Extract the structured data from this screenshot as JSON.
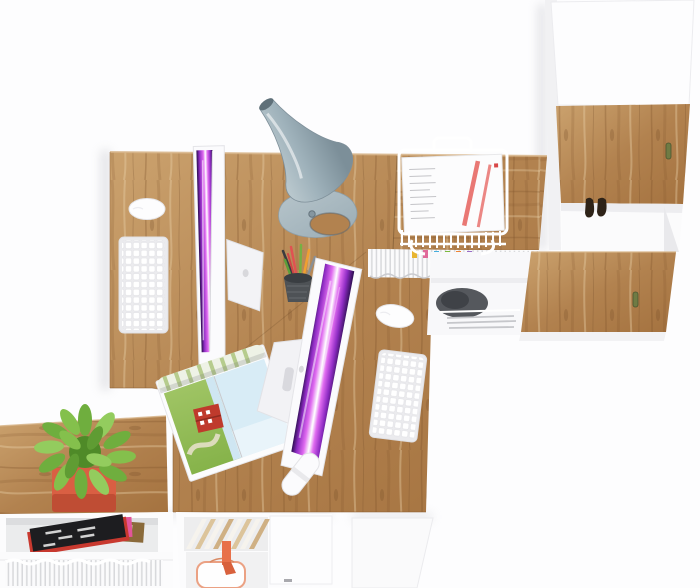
{
  "meta": {
    "type": "3d-product-render",
    "description": "Top-down view of a white and oak office furniture set: two desks with all-in-one computers, white keyboards and mice, a grey cone desk lamp, a wire document tray with papers, a tall cabinet with oak doors, a sideboard with a succulent plant in a red pot, and low white shelving holding magazines, files and a gift bag",
    "width": 700,
    "height": 588
  },
  "palette": {
    "background": "#fdfdfe",
    "wood_light": "#cba26e",
    "wood_mid": "#b2824f",
    "wood_deep": "#a4723f",
    "wood_edge": "#8e6136",
    "white_furniture": "#fcfcfd",
    "panel_shade": "#efeff2",
    "panel_edge": "#e4e4e8",
    "shadow": "#b9bac2",
    "lamp_light": "#ccd7da",
    "lamp_mid": "#9fb2bb",
    "lamp_dark": "#5f7079",
    "lamp_base": "#b7c5cb",
    "screen_dark": "#2a0d4e",
    "screen_violet": "#8f2cc4",
    "screen_magenta": "#e06bf0",
    "screen_white": "#ffffff",
    "plant_dark": "#4f8a28",
    "plant_mid": "#6fae3e",
    "plant_light": "#93cc5e",
    "pot_red": "#d95f43",
    "pot_red_dark": "#bf4d34",
    "ribbon_orange": "#e8714a",
    "ribbon_orange_dark": "#d8613c",
    "paper_stripe_red": "#e86a66",
    "handle_bronze": "#6f7b44",
    "magazine_black": "#1d1d20",
    "magazine_pink": "#e2559a",
    "magazine_red": "#c8392f",
    "magazine_gold": "#8a6a3a",
    "barn_red": "#bf3a2c",
    "sky_blue": "#d8ecf6",
    "field_green": "#86b34a",
    "tab_colors": [
      "#e8b531",
      "#e06a9a",
      "#46aede",
      "#7cb93e",
      "#ef8435",
      "#9a6cc8"
    ]
  },
  "objects": {
    "scene": {
      "label": "office furniture set seen from directly above"
    },
    "desk_left": {
      "label": "left desk with oak top"
    },
    "desk_right": {
      "label": "right desk with oak top"
    },
    "return_desk": {
      "label": "return desk section with oak top"
    },
    "cabinet": {
      "label": "tall white cabinet with two oak doors"
    },
    "cabinet_door_top": {
      "label": "upper oak cabinet door"
    },
    "cabinet_door_bottom": {
      "label": "lower oak cabinet door"
    },
    "cabinet_cubby": {
      "label": "open white cabinet compartment"
    },
    "dark_item": {
      "label": "small dark leather item hanging in cabinet compartment"
    },
    "sideboard": {
      "label": "low sideboard with oak top"
    },
    "shelf_left": {
      "label": "open white shelf with magazines and papers"
    },
    "shelf_center": {
      "label": "open white shelf with books and gift bag"
    },
    "desk_panel": {
      "label": "white desk side panel"
    },
    "imac_1": {
      "label": "all-in-one computer on left desk, screen showing purple abstract wallpaper"
    },
    "imac_2": {
      "label": "all-in-one computer on right desk, screen showing pink abstract wallpaper"
    },
    "keyboard_1": {
      "label": "white wireless keyboard on left desk"
    },
    "keyboard_2": {
      "label": "white wireless keyboard on right desk"
    },
    "mouse_1": {
      "label": "white mouse on left desk"
    },
    "mouse_2": {
      "label": "white mouse on right desk"
    },
    "lamp": {
      "label": "grey cone desk lamp"
    },
    "document_tray": {
      "label": "white wire document tray with papers"
    },
    "pencil_cup": {
      "label": "dark mesh pencil cup with pens"
    },
    "usb_drive": {
      "label": "white capsule shaped flash drive"
    },
    "magazine_open": {
      "label": "open magazine with farm landscape photo"
    },
    "magazine_stack": {
      "label": "stack of magazines on shelf"
    },
    "file_folders": {
      "label": "row of white files with coloured index tabs"
    },
    "paper_row": {
      "label": "row of upright white papers"
    },
    "books_diagonal": {
      "label": "leaning white and kraft books"
    },
    "gift_bag": {
      "label": "white gift bag with orange ribbon"
    },
    "plant": {
      "label": "green succulent in red square pot"
    },
    "pedestal": {
      "label": "under-desk shelf with dark bag"
    }
  }
}
